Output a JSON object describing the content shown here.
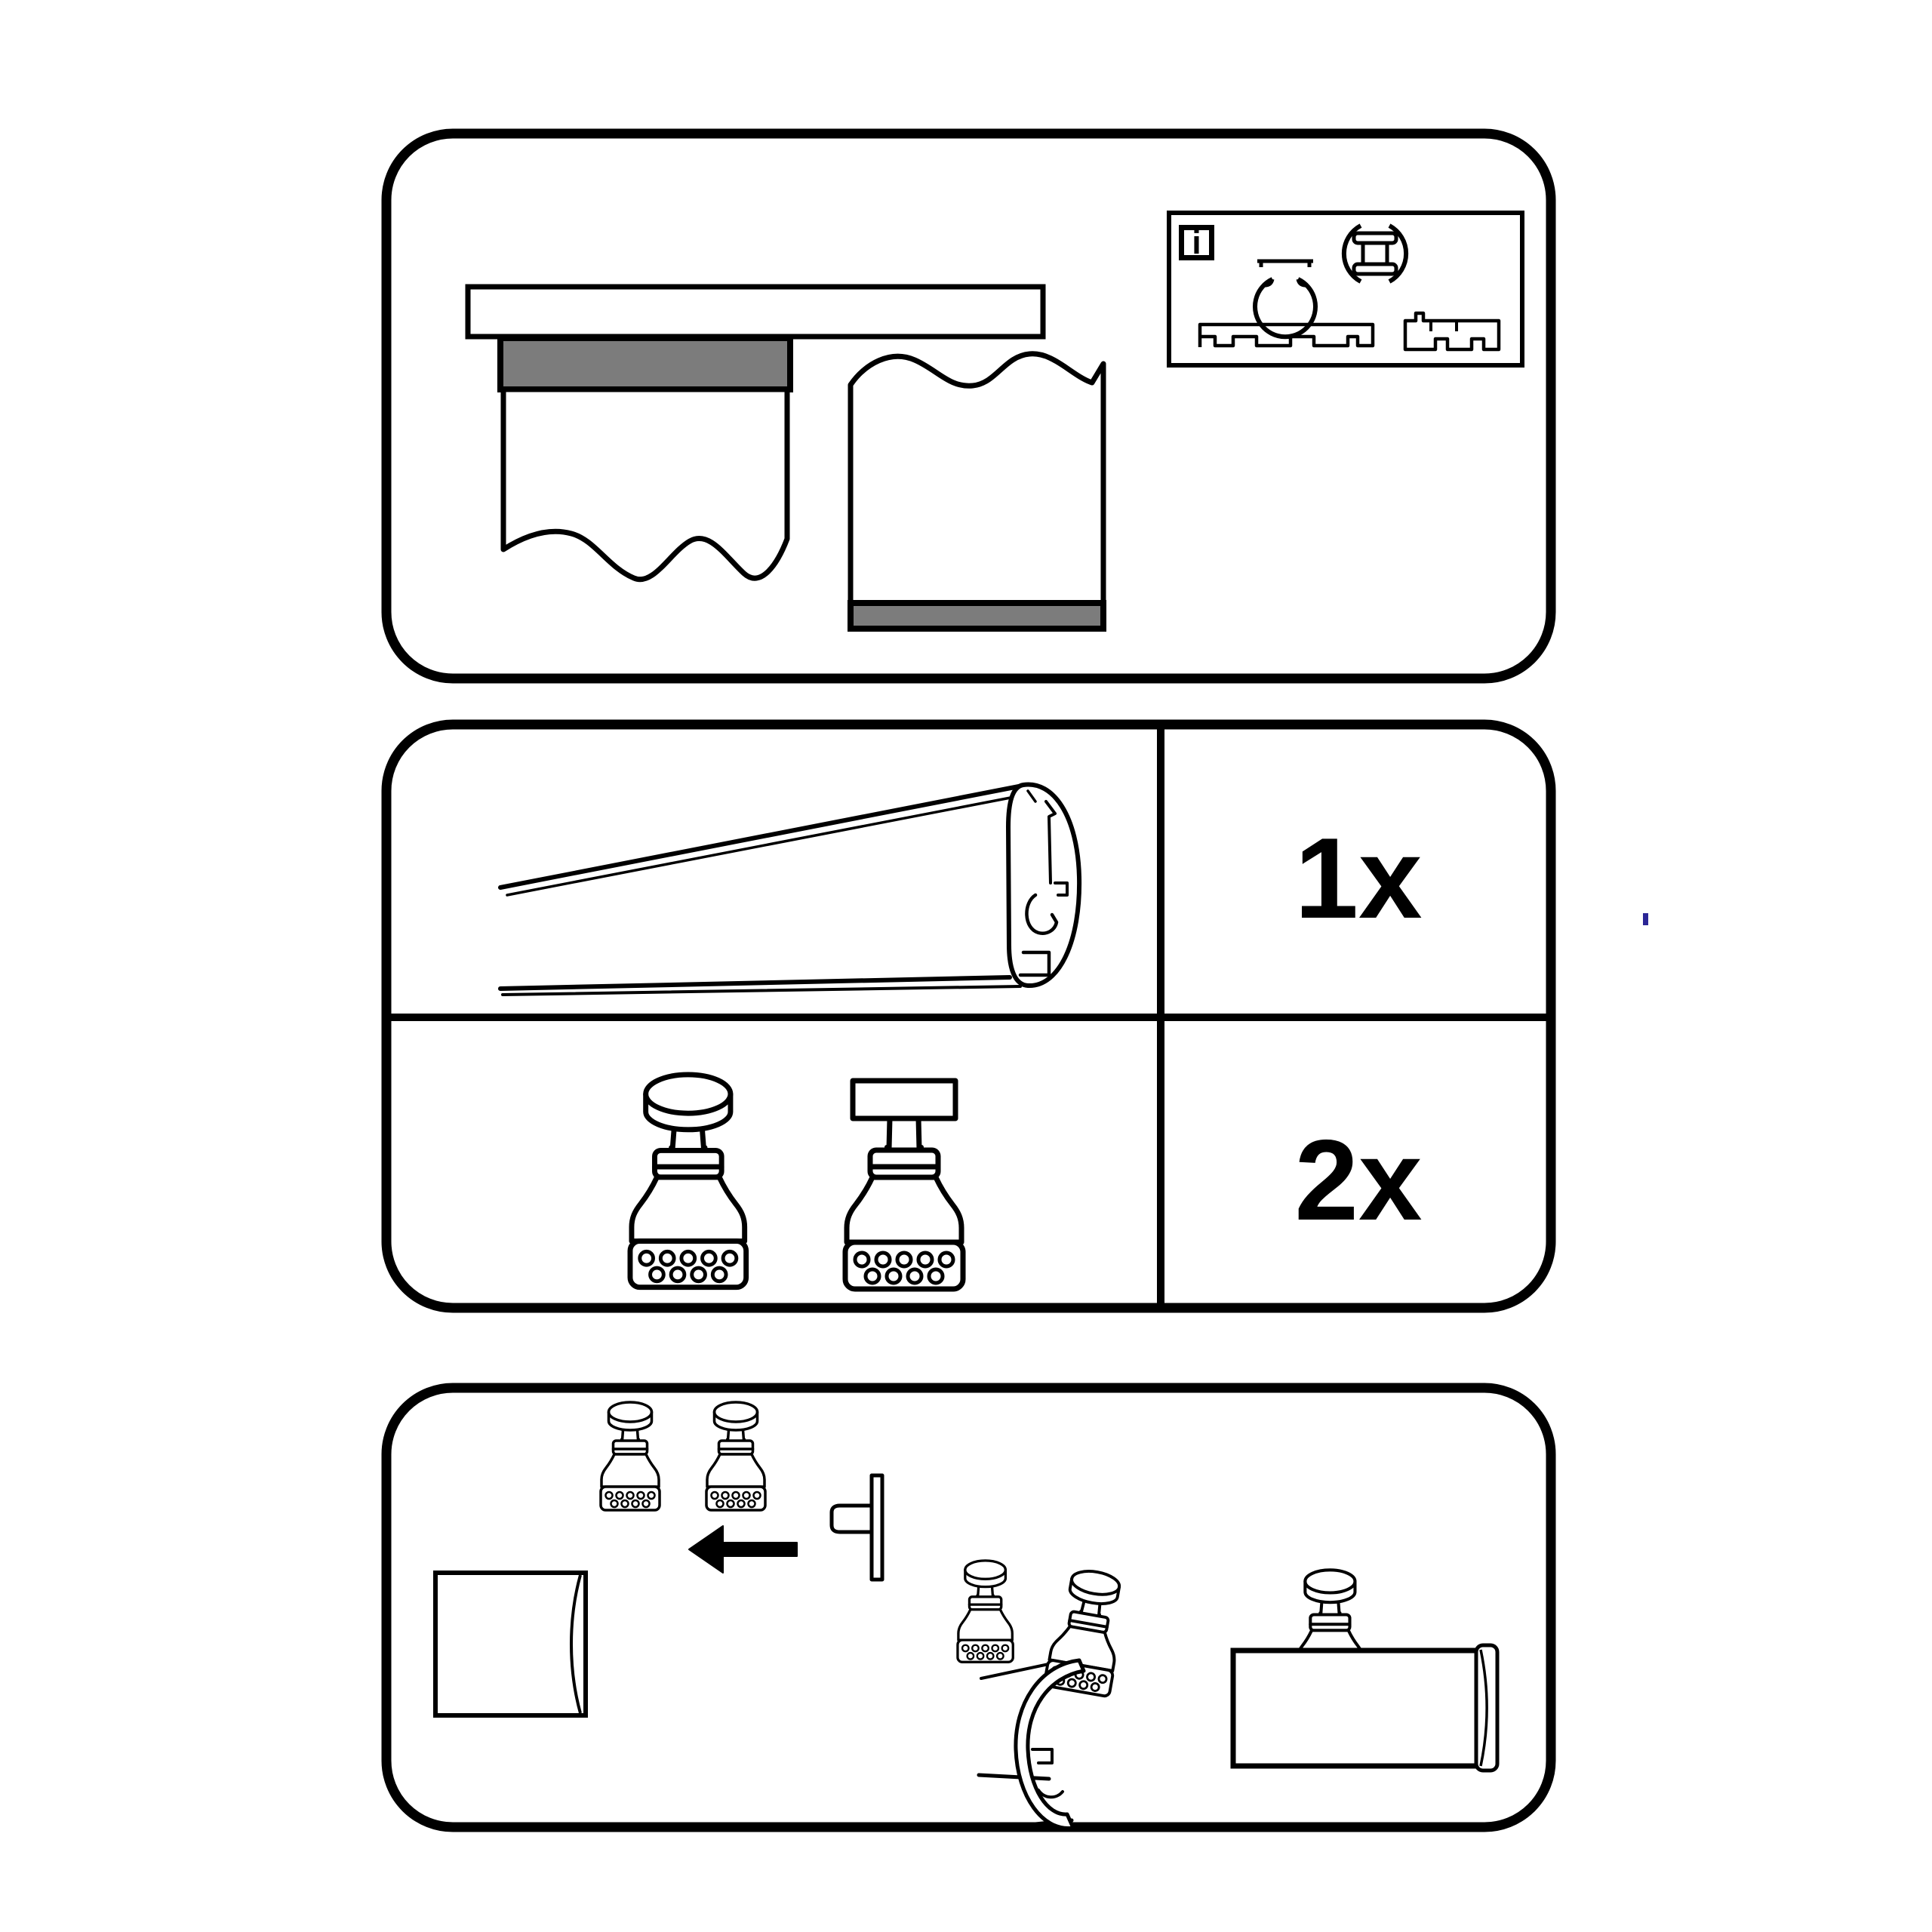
{
  "sheet": {
    "kind": "curtain-rail assembly instruction sheet",
    "colors": {
      "paper": "#ffffff",
      "ink": "#000000",
      "band_gray": "#7c7c7c",
      "stray_mark_blue": "#2b2696"
    }
  },
  "overview_panel": {
    "info_icon": "i",
    "illustrations": [
      "ceiling-rail-bar",
      "curtain-with-gray-heading-band",
      "fabric-panel-with-gray-bottom-band"
    ],
    "compatible_profiles": [
      "round-c-rail-profile",
      "round-double-channel-rail-profile",
      "wide-multi-channel-track-profile",
      "compact-track-profile"
    ]
  },
  "parts_panel": {
    "rows": [
      {
        "part": "rail-profile-perspective",
        "qty": "1x"
      },
      {
        "part": "glider-adapter-round-head-and-t-head",
        "qty": "2x"
      }
    ]
  },
  "assembly_panel": {
    "arrow_direction": "left",
    "steps": [
      "two-adapters-above-fabric-panel",
      "arrow-toward-rail-end-stud",
      "adapter-clipped-into-rail-profile",
      "adapter-mounted-on-rail-side-view"
    ]
  }
}
